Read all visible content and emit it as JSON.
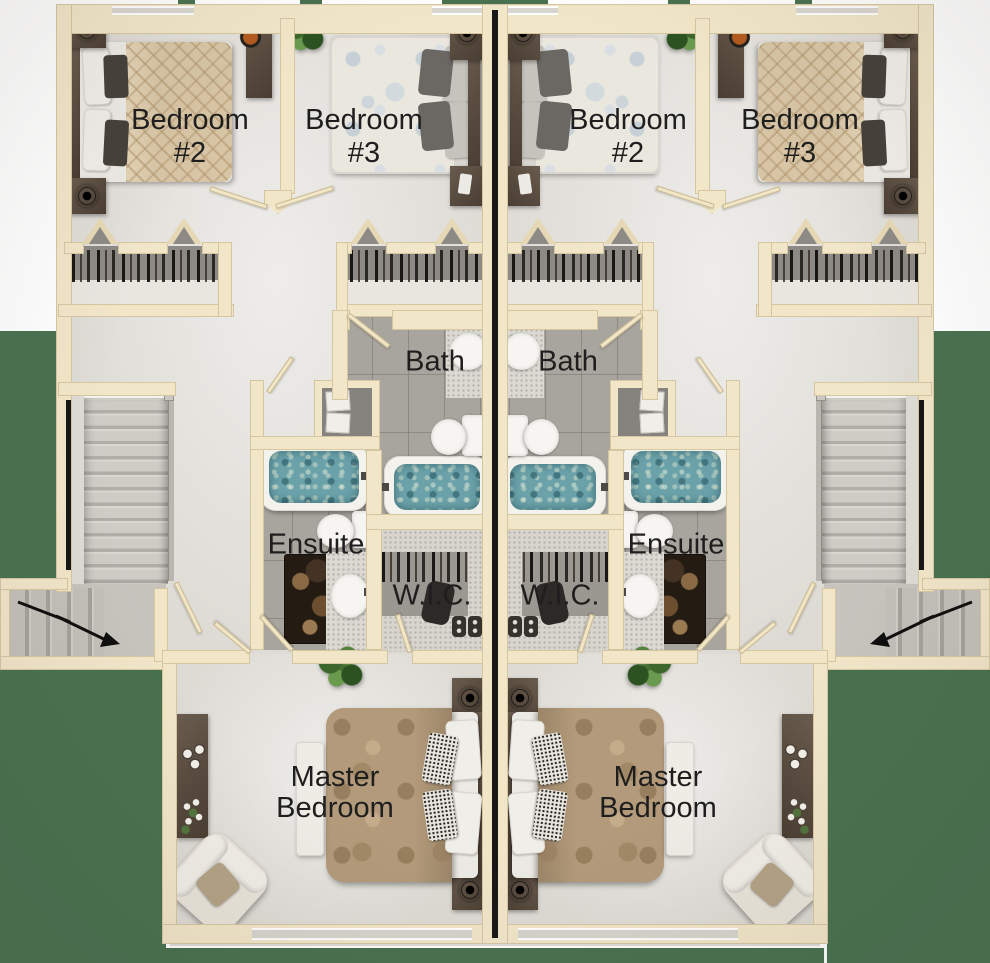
{
  "floor_plan": {
    "units": [
      {
        "side": "left",
        "rooms": [
          "Bedroom #2",
          "Bedroom #3",
          "Bath",
          "Ensuite",
          "W.I.C.",
          "Master Bedroom"
        ]
      },
      {
        "side": "right",
        "rooms": [
          "Bedroom #2",
          "Bedroom #3",
          "Bath",
          "Ensuite",
          "W.I.C.",
          "Master Bedroom"
        ]
      }
    ]
  },
  "labels": {
    "bedroom2_line1": "Bedroom",
    "bedroom2_line2": "#2",
    "bedroom3_line1": "Bedroom",
    "bedroom3_line2": "#3",
    "bath": "Bath",
    "ensuite": "Ensuite",
    "wic": "W.I.C.",
    "master_line1": "Master",
    "master_line2": "Bedroom"
  },
  "colors": {
    "lawn": "#48714f",
    "wall": "#f2e6c9",
    "wall_edge": "#d6c6a0",
    "floor": "#dedbd5",
    "tile": "#a8a49e",
    "water": "#6ba2aa",
    "wood": "#5a4d41",
    "label_text": "#1e1e1e"
  }
}
